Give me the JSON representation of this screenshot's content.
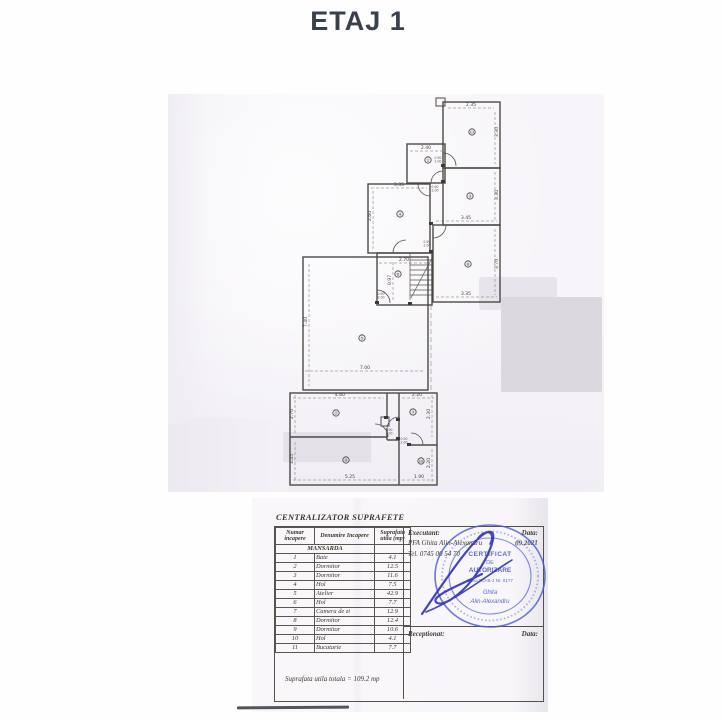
{
  "page": {
    "title": "ETAJ 1"
  },
  "plan": {
    "dims": [
      "2.35",
      "2.40",
      "3.35",
      "3.45",
      "2.70",
      "3.35",
      "7.00",
      "4.60",
      "2.20",
      "5.25",
      "1.90",
      "3.30",
      "3.30",
      "3.70",
      "2.60",
      "0.97",
      "7.40",
      "2.70",
      "3.45",
      "2.30",
      "2.20"
    ],
    "markers": [
      "11",
      "1",
      "3",
      "8",
      "4",
      "6",
      "5",
      "2",
      "7",
      "9",
      "10"
    ],
    "door_label": {
      "w": "0.90",
      "h": "2.00"
    }
  },
  "table": {
    "title": "CENTRALIZATOR SUPRAFETE",
    "headers": [
      "Numar incapere",
      "Denumire Incapere",
      "Suprafata utila (mp)"
    ],
    "section": "MANSARDA",
    "rows": [
      {
        "num": "1",
        "name": "Baie",
        "area": "4.1"
      },
      {
        "num": "2",
        "name": "Dormitor",
        "area": "12.5"
      },
      {
        "num": "3",
        "name": "Dormitor",
        "area": "11.6"
      },
      {
        "num": "4",
        "name": "Hol",
        "area": "7.5"
      },
      {
        "num": "5",
        "name": "Atelier",
        "area": "42.9"
      },
      {
        "num": "6",
        "name": "Hol",
        "area": "7.7"
      },
      {
        "num": "7",
        "name": "Camera de zi",
        "area": "12.9"
      },
      {
        "num": "8",
        "name": "Dormitor",
        "area": "12.4"
      },
      {
        "num": "9",
        "name": "Dormitor",
        "area": "10.6"
      },
      {
        "num": "10",
        "name": "Hol",
        "area": "4.1"
      },
      {
        "num": "11",
        "name": "Bucatarie",
        "area": "7.7"
      }
    ],
    "total": "Suprafata utila totala = 109.2 mp"
  },
  "executant": {
    "label": "Executant:",
    "name": "PFA Ghita Alin-Alexandru",
    "date_label": "Data:",
    "date": "09.2021",
    "tel": "Tel. 0745 00 54 70",
    "receptionat_label": "Receptionat:",
    "date_label2": "Data:"
  },
  "stamp": {
    "l1": "CERTIFICAT",
    "l2": "DE",
    "l3": "AUTORIZARE",
    "l4": "Seria RO-B-J Nr. 0177",
    "l5": "Ghita",
    "l6": "Alin-Alexandru"
  }
}
